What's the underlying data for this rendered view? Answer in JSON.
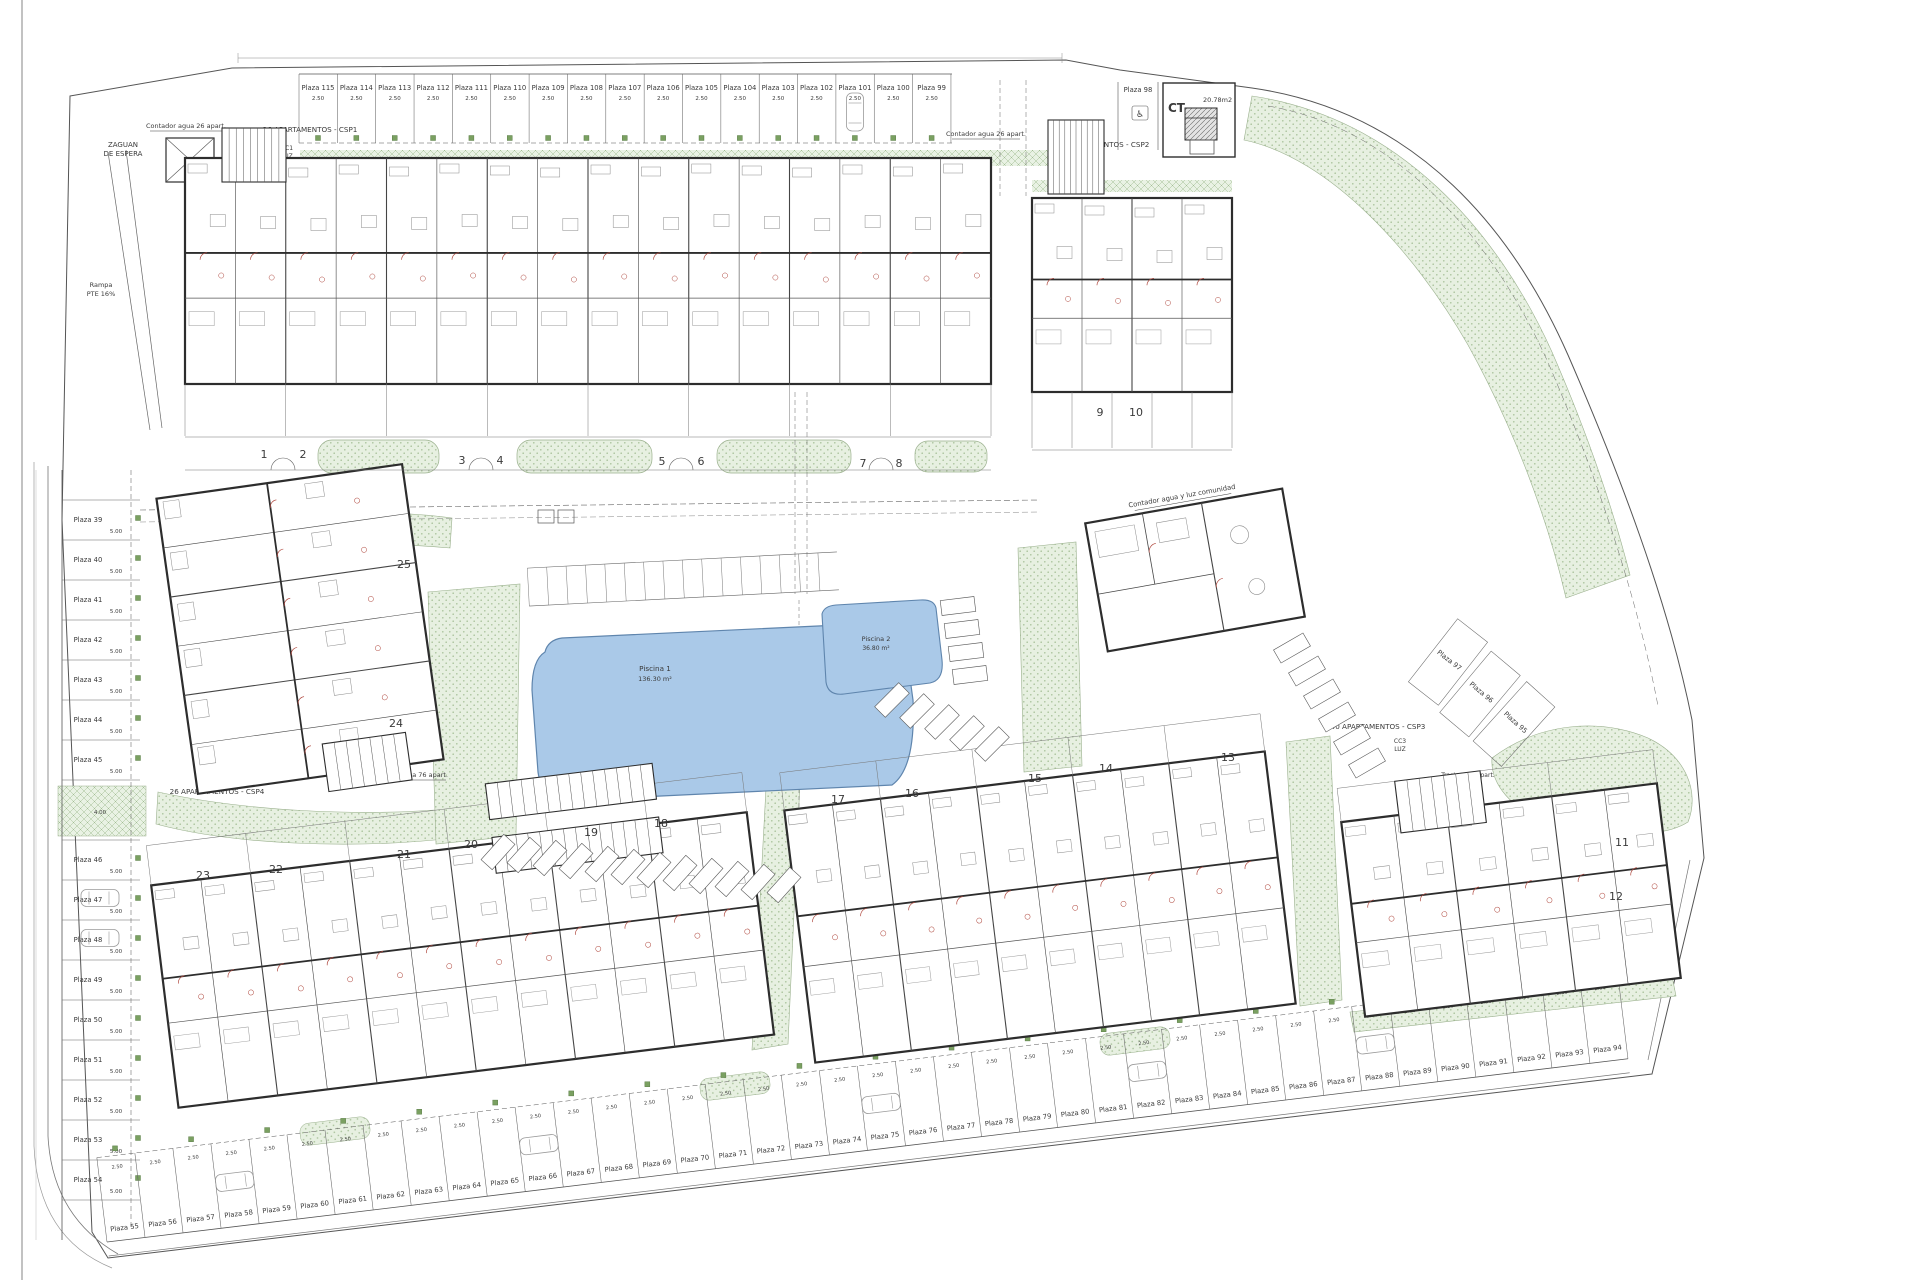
{
  "drawing": {
    "labels": {
      "zaguan_l1": "ZAGUAN",
      "zaguan_l2": "DE ESPERA",
      "rampa_l1": "Rampa",
      "rampa_l2": "PTE 16%",
      "csp1": "26 APARTAMENTOS - CSP1",
      "csp2": "26 APARTAMENTOS - CSP2",
      "csp3": "40 APARTAMENTOS - CSP3",
      "csp4": "26 APARTAMENTOS - CSP4",
      "contador26_left": "Contador agua 26 apart.",
      "contador26_right": "Contador agua 26 apart.",
      "contador76": "Contador agua 76 apart.",
      "contador_comunidad": "Contador agua y luz comunidad",
      "cc1_l1": "CC1",
      "cc1_l2": "LUZ",
      "cc3_l1": "CC3",
      "cc3_l2": "LUZ",
      "cc4_l1": "CC4",
      "cc4_l2": "LUZ",
      "ct": "CT",
      "ct_area": "20.78m2",
      "trastero_l1": "Trastero 75 apart.",
      "trastero_l2": "3.00 m²",
      "stall_width_dim": "2.50",
      "stall_depth_dim": "5.00",
      "gap_dim": "4.00"
    },
    "icons": {
      "disabled_parking": "♿"
    },
    "pools": [
      {
        "name": "Piscina 1",
        "area": "136.30 m²"
      },
      {
        "name": "Piscina 2",
        "area": "36.80 m²"
      }
    ],
    "parking": {
      "top_row": [
        "Plaza 115",
        "Plaza 114",
        "Plaza 113",
        "Plaza 112",
        "Plaza 111",
        "Plaza 110",
        "Plaza 109",
        "Plaza 108",
        "Plaza 107",
        "Plaza 106",
        "Plaza 105",
        "Plaza 104",
        "Plaza 103",
        "Plaza 102",
        "Plaza 101",
        "Plaza 100",
        "Plaza 99"
      ],
      "left_col": [
        "Plaza 39",
        "Plaza 40",
        "Plaza 41",
        "Plaza 42",
        "Plaza 43",
        "Plaza 44",
        "Plaza 45",
        "Plaza 46",
        "Plaza 47",
        "Plaza 48",
        "Plaza 49",
        "Plaza 50",
        "Plaza 51",
        "Plaza 52",
        "Plaza 53",
        "Plaza 54"
      ],
      "bottom_row": [
        "Plaza 55",
        "Plaza 56",
        "Plaza 57",
        "Plaza 58",
        "Plaza 59",
        "Plaza 60",
        "Plaza 61",
        "Plaza 62",
        "Plaza 63",
        "Plaza 64",
        "Plaza 65",
        "Plaza 66",
        "Plaza 67",
        "Plaza 68",
        "Plaza 69",
        "Plaza 70",
        "Plaza 71",
        "Plaza 72",
        "Plaza 73",
        "Plaza 74",
        "Plaza 75",
        "Plaza 76",
        "Plaza 77",
        "Plaza 78",
        "Plaza 79",
        "Plaza 80",
        "Plaza 81",
        "Plaza 82",
        "Plaza 83",
        "Plaza 84",
        "Plaza 85",
        "Plaza 86",
        "Plaza 87",
        "Plaza 88",
        "Plaza 89",
        "Plaza 90",
        "Plaza 91",
        "Plaza 92",
        "Plaza 93",
        "Plaza 94"
      ],
      "fan": [
        "Plaza 97",
        "Plaza 96",
        "Plaza 95"
      ],
      "ct_stall": "Plaza 98"
    },
    "block_numbers": [
      {
        "label": "1",
        "x": 264,
        "y": 458
      },
      {
        "label": "2",
        "x": 303,
        "y": 458
      },
      {
        "label": "3",
        "x": 462,
        "y": 464
      },
      {
        "label": "4",
        "x": 500,
        "y": 464
      },
      {
        "label": "5",
        "x": 662,
        "y": 465
      },
      {
        "label": "6",
        "x": 701,
        "y": 465
      },
      {
        "label": "7",
        "x": 863,
        "y": 467
      },
      {
        "label": "8",
        "x": 899,
        "y": 467
      },
      {
        "label": "9",
        "x": 1100,
        "y": 416
      },
      {
        "label": "10",
        "x": 1136,
        "y": 416
      },
      {
        "label": "11",
        "x": 1622,
        "y": 846
      },
      {
        "label": "12",
        "x": 1616,
        "y": 900
      },
      {
        "label": "13",
        "x": 1228,
        "y": 761
      },
      {
        "label": "14",
        "x": 1106,
        "y": 772
      },
      {
        "label": "15",
        "x": 1035,
        "y": 782
      },
      {
        "label": "16",
        "x": 912,
        "y": 797
      },
      {
        "label": "17",
        "x": 838,
        "y": 803
      },
      {
        "label": "18",
        "x": 661,
        "y": 827
      },
      {
        "label": "19",
        "x": 591,
        "y": 836
      },
      {
        "label": "20",
        "x": 471,
        "y": 848
      },
      {
        "label": "21",
        "x": 404,
        "y": 858
      },
      {
        "label": "22",
        "x": 276,
        "y": 873
      },
      {
        "label": "23",
        "x": 203,
        "y": 879
      },
      {
        "label": "24",
        "x": 396,
        "y": 727
      },
      {
        "label": "25",
        "x": 404,
        "y": 568
      }
    ],
    "colors": {
      "paper": "#ffffff",
      "line_dark": "#2d2d2d",
      "line_mid": "#555555",
      "green_fill": "#e7f0e1",
      "green_dot": "#a9c29b",
      "green_square": "#7aa061",
      "pool_fill": "#aac9e8",
      "pool_edge": "#5f85ad",
      "door_red": "#b0493f"
    }
  }
}
